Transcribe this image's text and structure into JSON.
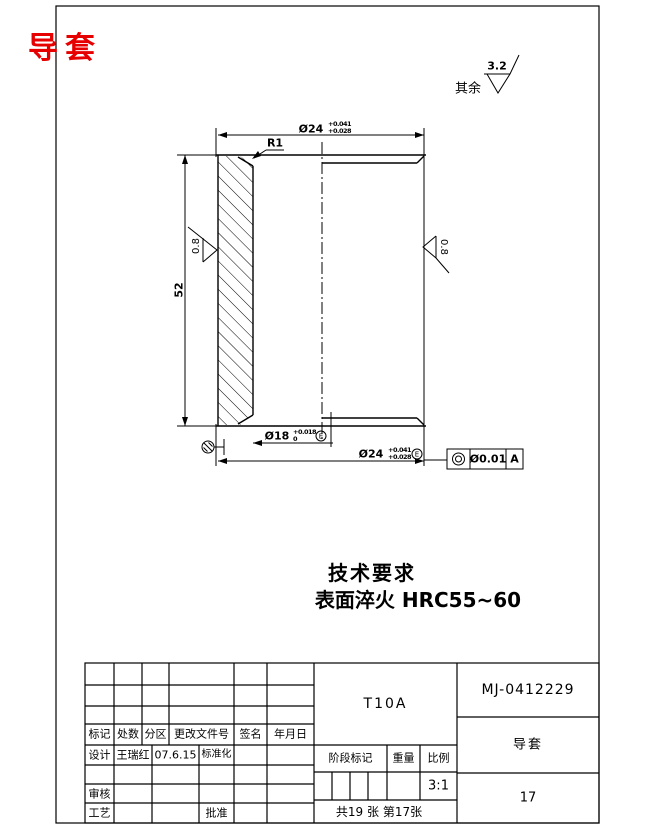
{
  "page": {
    "background": "#ffffff",
    "line_color": "#000000",
    "accent_red": "#e60000"
  },
  "header": {
    "part_title": "导套",
    "general_roughness_label": "其余",
    "general_roughness_value": "3.2"
  },
  "drawing": {
    "dim_od_top": {
      "nominal": "Ø24",
      "tol_upper": "+0.041",
      "tol_lower": "+0.028"
    },
    "fillet_label": "R1",
    "dim_length": "52",
    "roughness_left": "0.8",
    "roughness_right": "0.8",
    "dim_bore": {
      "nominal": "Ø18",
      "tol_upper": "+0.018",
      "tol_lower": "0",
      "envelope": "E"
    },
    "dim_od_bottom": {
      "nominal": "Ø24",
      "tol_upper": "+0.041",
      "tol_lower": "+0.028",
      "envelope": "E"
    },
    "fcf": {
      "symbol_name": "concentricity",
      "tolerance": "Ø0.01",
      "datum": "A"
    }
  },
  "tech_req": {
    "title": "技术要求",
    "line1": "表面淬火 HRC55~60"
  },
  "title_block": {
    "header_row": {
      "mark": "标记",
      "count": "处数",
      "zone": "分区",
      "change_doc_no": "更改文件号",
      "signature": "签名",
      "date": "年月日"
    },
    "design_label": "设计",
    "designer_name": "王瑞红",
    "design_date": "07.6.15",
    "standardization_label": "标准化",
    "check_label": "审核",
    "process_label": "工艺",
    "approve_label": "批准",
    "material_grade": "T10A",
    "drawing_number": "MJ-0412229",
    "part_name": "导套",
    "stage_mark_label": "阶段标记",
    "weight_label": "重量",
    "scale_label": "比例",
    "scale_value": "3:1",
    "sheet_info": "共19 张 第17张",
    "sheet_number": "17"
  }
}
